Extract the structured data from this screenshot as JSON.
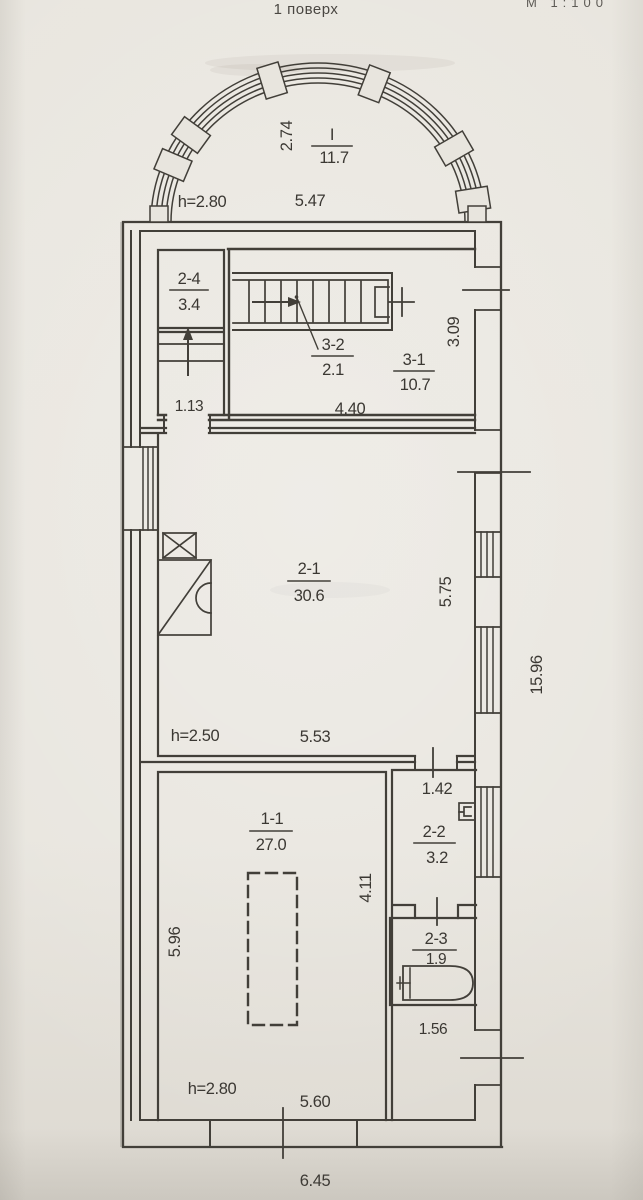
{
  "title": "1 поверх",
  "corner_note": "М 1:100",
  "unit": {
    "number": "I",
    "area": "11.7"
  },
  "bay": {
    "height": "h=2.80",
    "width": "5.47",
    "depth": "2.74"
  },
  "rooms": {
    "r24": {
      "number": "2-4",
      "area": "3.4"
    },
    "r32": {
      "number": "3-2",
      "area": "2.1"
    },
    "r31": {
      "number": "3-1",
      "area": "10.7"
    },
    "r21": {
      "number": "2-1",
      "area": "30.6"
    },
    "r11": {
      "number": "1-1",
      "area": "27.0"
    },
    "r22": {
      "number": "2-2",
      "area": "3.2"
    },
    "r23": {
      "number": "2-3",
      "area": "1.9"
    }
  },
  "dims": {
    "w113": "1.13",
    "w440": "4.40",
    "h309": "3.09",
    "h250": "h=2.50",
    "w553": "5.53",
    "h575": "5.75",
    "w142": "1.42",
    "h411": "4.11",
    "h596": "5.96",
    "w156": "1.56",
    "h280b": "h=2.80",
    "w560": "5.60",
    "w645": "6.45",
    "h1596": "15.96"
  },
  "colors": {
    "paper": "#e8e5de",
    "ink": "#423f39"
  }
}
